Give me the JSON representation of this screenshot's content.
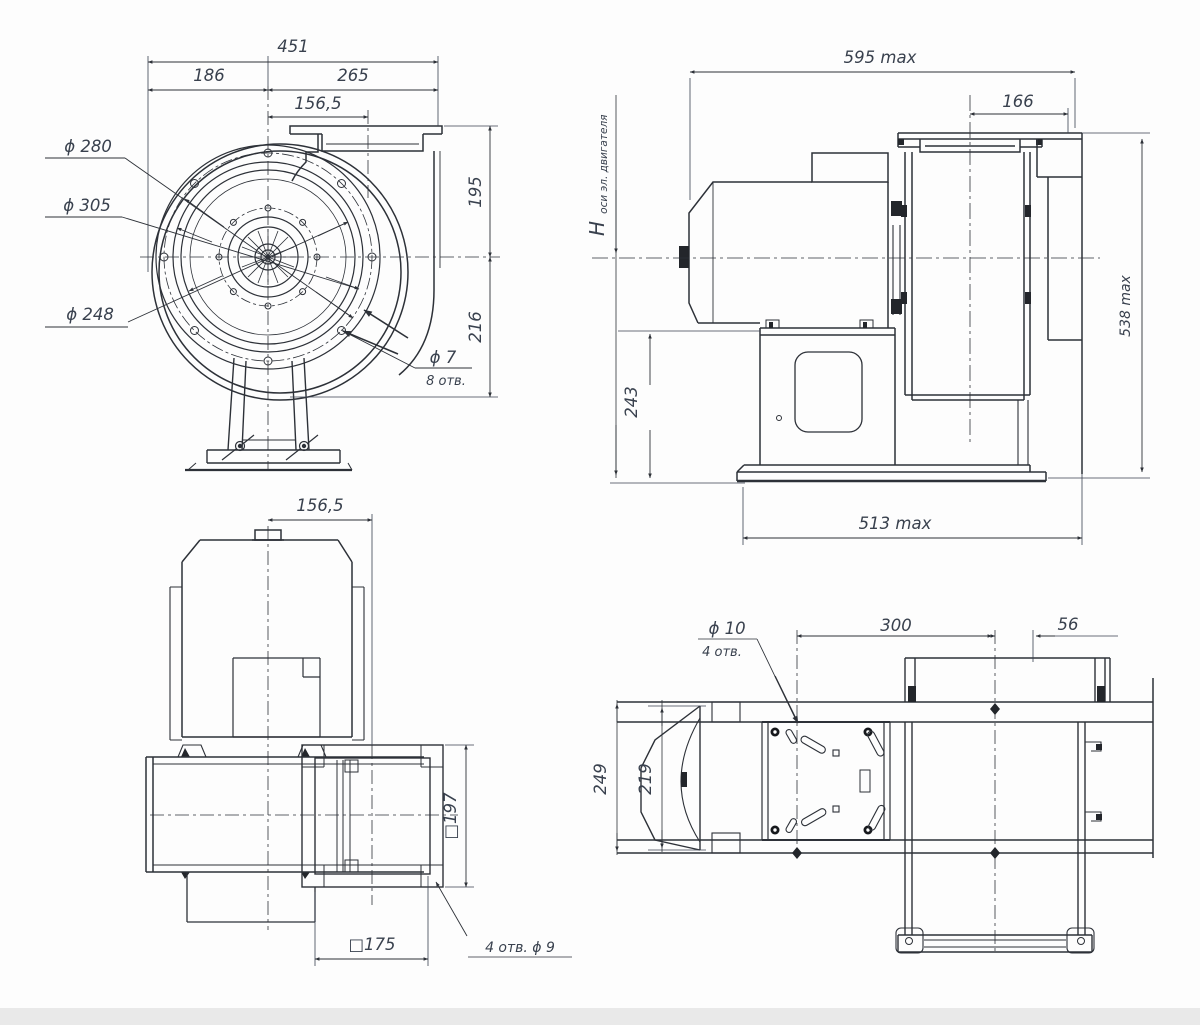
{
  "drawing": {
    "type": "technical-drawing",
    "subject": "centrifugal-fan-dimension-drawing",
    "colors": {
      "line": "#2d3138",
      "dim": "#3a4150",
      "text": "#39414e",
      "background": "#fdfdfd",
      "bottom_strip": "#e9e9e9"
    },
    "front_view": {
      "dim_451": "451",
      "dim_186": "186",
      "dim_265": "265",
      "dim_156": "156,5",
      "dia_280": "ϕ 280",
      "dia_305": "ϕ 305",
      "dia_248": "ϕ 248",
      "dim_195": "195",
      "dim_216": "216",
      "holes_dia": "ϕ 7",
      "holes_qty": "8 отв."
    },
    "side_view": {
      "dim_595": "595 max",
      "dim_166": "166",
      "axis_h": "H",
      "axis_h_sub": "оси эл. двигателя",
      "dim_243": "243",
      "dim_538": "538 max",
      "dim_513": "513 max"
    },
    "top_view": {
      "dim_156": "156,5",
      "dim_197": "□197",
      "dim_175": "□175",
      "holes_note": "4 отв. ϕ 9"
    },
    "inlet_plan_view": {
      "holes_dia": "ϕ 10",
      "holes_qty": "4 отв.",
      "dim_300": "300",
      "dim_56": "56",
      "dim_249": "249",
      "dim_219": "219"
    }
  }
}
